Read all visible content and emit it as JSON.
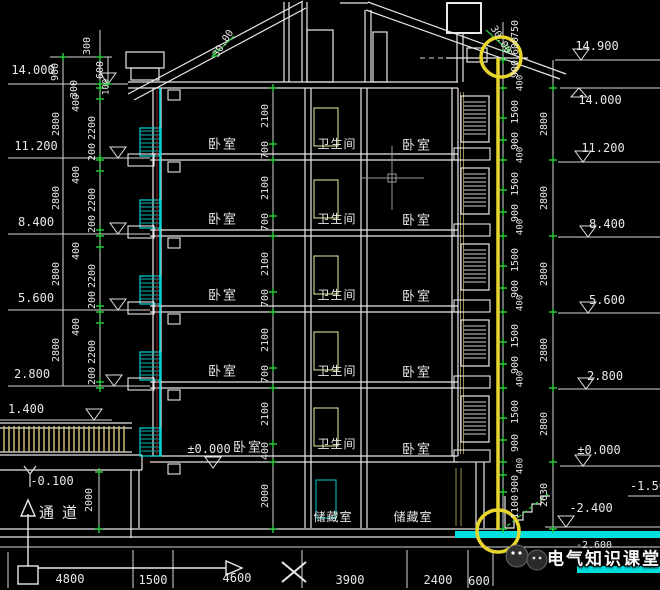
{
  "colors": {
    "background": "#000000",
    "structure_line": "#e8e8e8",
    "cyan": "#00d8d8",
    "green_tick": "#2ecc40",
    "highlight_yellow": "#e8d52c",
    "door_yellow": "#d8d890",
    "wall_core_red": "#8b2020",
    "tan": "#9a8a50"
  },
  "watermark": {
    "text": "电气知识课堂"
  },
  "annotations": [
    {
      "name": "elevation-left-14000",
      "text": "14.000",
      "x": 33,
      "y": 70,
      "size": 12
    },
    {
      "name": "elevation-left-11200",
      "text": "11.200",
      "x": 36,
      "y": 146,
      "size": 12
    },
    {
      "name": "elevation-left-8400",
      "text": "8.400",
      "x": 36,
      "y": 222,
      "size": 12
    },
    {
      "name": "elevation-left-5600",
      "text": "5.600",
      "x": 36,
      "y": 298,
      "size": 12
    },
    {
      "name": "elevation-left-2800",
      "text": "2.800",
      "x": 32,
      "y": 374,
      "size": 12
    },
    {
      "name": "elevation-left-1400",
      "text": "1.400",
      "x": 26,
      "y": 409,
      "size": 12
    },
    {
      "name": "elevation-left-minus-0100",
      "text": "-0.100",
      "x": 52,
      "y": 481,
      "size": 12
    },
    {
      "name": "elevation-left-pm-0000",
      "text": "±0.000",
      "x": 209,
      "y": 449,
      "size": 12
    },
    {
      "name": "elevation-right-14900",
      "text": "14.900",
      "x": 597,
      "y": 46,
      "size": 12
    },
    {
      "name": "elevation-right-14000",
      "text": "14.000",
      "x": 600,
      "y": 100,
      "size": 12
    },
    {
      "name": "elevation-right-11200",
      "text": "11.200",
      "x": 603,
      "y": 148,
      "size": 12
    },
    {
      "name": "elevation-right-8400",
      "text": "8.400",
      "x": 607,
      "y": 224,
      "size": 12
    },
    {
      "name": "elevation-right-5600",
      "text": "5.600",
      "x": 607,
      "y": 300,
      "size": 12
    },
    {
      "name": "elevation-right-2800",
      "text": "2.800",
      "x": 605,
      "y": 376,
      "size": 12
    },
    {
      "name": "elevation-right-pm-0000",
      "text": "±0.000",
      "x": 599,
      "y": 450,
      "size": 12
    },
    {
      "name": "elevation-right-minus-2400",
      "text": "-2.400",
      "x": 591,
      "y": 508,
      "size": 12
    },
    {
      "name": "elevation-right-minus-1500",
      "text": "-1.50",
      "x": 648,
      "y": 486,
      "size": 12
    },
    {
      "name": "elevation-right-minus-2600",
      "text": "-2.600",
      "x": 594,
      "y": 546,
      "size": 10
    },
    {
      "name": "room-bedroom-left-attic",
      "text": "卧室",
      "x": 223,
      "y": 144,
      "size": 13,
      "ls": 2,
      "cjk": 1
    },
    {
      "name": "room-bedroom-left-4f",
      "text": "卧室",
      "x": 223,
      "y": 219,
      "size": 13,
      "ls": 2,
      "cjk": 1
    },
    {
      "name": "room-bedroom-left-3f",
      "text": "卧室",
      "x": 223,
      "y": 295,
      "size": 13,
      "ls": 2,
      "cjk": 1
    },
    {
      "name": "room-bedroom-left-2f",
      "text": "卧室",
      "x": 223,
      "y": 371,
      "size": 13,
      "ls": 2,
      "cjk": 1
    },
    {
      "name": "room-bedroom-left-1f",
      "text": "卧室",
      "x": 248,
      "y": 447,
      "size": 13,
      "ls": 2,
      "cjk": 1
    },
    {
      "name": "room-bathroom-attic",
      "text": "卫生间",
      "x": 337,
      "y": 144,
      "size": 12,
      "ls": 1,
      "cjk": 1
    },
    {
      "name": "room-bathroom-4f",
      "text": "卫生间",
      "x": 337,
      "y": 219,
      "size": 12,
      "ls": 1,
      "cjk": 1
    },
    {
      "name": "room-bathroom-3f",
      "text": "卫生间",
      "x": 337,
      "y": 295,
      "size": 12,
      "ls": 1,
      "cjk": 1
    },
    {
      "name": "room-bathroom-2f",
      "text": "卫生间",
      "x": 337,
      "y": 371,
      "size": 12,
      "ls": 1,
      "cjk": 1
    },
    {
      "name": "room-bathroom-1f",
      "text": "卫生间",
      "x": 337,
      "y": 444,
      "size": 12,
      "ls": 1,
      "cjk": 1
    },
    {
      "name": "room-bedroom-right-attic",
      "text": "卧室",
      "x": 417,
      "y": 145,
      "size": 13,
      "ls": 2,
      "cjk": 1
    },
    {
      "name": "room-bedroom-right-4f",
      "text": "卧室",
      "x": 417,
      "y": 220,
      "size": 13,
      "ls": 2,
      "cjk": 1
    },
    {
      "name": "room-bedroom-right-3f",
      "text": "卧室",
      "x": 417,
      "y": 296,
      "size": 13,
      "ls": 2,
      "cjk": 1
    },
    {
      "name": "room-bedroom-right-2f",
      "text": "卧室",
      "x": 417,
      "y": 372,
      "size": 13,
      "ls": 2,
      "cjk": 1
    },
    {
      "name": "room-bedroom-right-1f",
      "text": "卧室",
      "x": 417,
      "y": 449,
      "size": 13,
      "ls": 2,
      "cjk": 1
    },
    {
      "name": "room-storage-1",
      "text": "储藏室",
      "x": 333,
      "y": 517,
      "size": 12,
      "ls": 1,
      "cjk": 1
    },
    {
      "name": "room-storage-2",
      "text": "储藏室",
      "x": 413,
      "y": 517,
      "size": 12,
      "ls": 1,
      "cjk": 1
    },
    {
      "name": "room-passage",
      "text": "通道",
      "x": 62,
      "y": 513,
      "size": 15,
      "ls": 8,
      "cjk": 1
    },
    {
      "name": "dim-topleft-900",
      "text": "900",
      "x": 56,
      "y": 72,
      "size": 10,
      "rot": -90
    },
    {
      "name": "dim-topleft-300a",
      "text": "300",
      "x": 88,
      "y": 46,
      "size": 10,
      "rot": -90
    },
    {
      "name": "dim-topleft-600",
      "text": "600",
      "x": 101,
      "y": 70,
      "size": 10,
      "rot": -90
    },
    {
      "name": "dim-topleft-100",
      "text": "100",
      "x": 107,
      "y": 87,
      "size": 9,
      "rot": -90
    },
    {
      "name": "dim-topleft-300b",
      "text": "300",
      "x": 75,
      "y": 89,
      "size": 10,
      "rot": -90
    },
    {
      "name": "dim-left-2800-1",
      "text": "2800",
      "x": 57,
      "y": 124,
      "size": 10,
      "rot": -90
    },
    {
      "name": "dim-left-2800-2",
      "text": "2800",
      "x": 57,
      "y": 198,
      "size": 10,
      "rot": -90
    },
    {
      "name": "dim-left-2800-3",
      "text": "2800",
      "x": 57,
      "y": 274,
      "size": 10,
      "rot": -90
    },
    {
      "name": "dim-left-2800-4",
      "text": "2800",
      "x": 57,
      "y": 350,
      "size": 10,
      "rot": -90
    },
    {
      "name": "dim-left-400-1",
      "text": "400",
      "x": 77,
      "y": 103,
      "size": 10,
      "rot": -90
    },
    {
      "name": "dim-left-400-2",
      "text": "400",
      "x": 77,
      "y": 175,
      "size": 10,
      "rot": -90
    },
    {
      "name": "dim-left-400-3",
      "text": "400",
      "x": 77,
      "y": 251,
      "size": 10,
      "rot": -90
    },
    {
      "name": "dim-left-400-4",
      "text": "400",
      "x": 77,
      "y": 327,
      "size": 10,
      "rot": -90
    },
    {
      "name": "dim-left-2200-1",
      "text": "2200",
      "x": 93,
      "y": 128,
      "size": 10,
      "rot": -90
    },
    {
      "name": "dim-left-2200-2",
      "text": "2200",
      "x": 93,
      "y": 200,
      "size": 10,
      "rot": -90
    },
    {
      "name": "dim-left-2200-3",
      "text": "2200",
      "x": 93,
      "y": 276,
      "size": 10,
      "rot": -90
    },
    {
      "name": "dim-left-2200-4",
      "text": "2200",
      "x": 93,
      "y": 352,
      "size": 10,
      "rot": -90
    },
    {
      "name": "dim-left-200-1",
      "text": "200",
      "x": 93,
      "y": 152,
      "size": 10,
      "rot": -90
    },
    {
      "name": "dim-left-200-2",
      "text": "200",
      "x": 93,
      "y": 224,
      "size": 10,
      "rot": -90
    },
    {
      "name": "dim-left-200-3",
      "text": "200",
      "x": 93,
      "y": 300,
      "size": 10,
      "rot": -90
    },
    {
      "name": "dim-left-200-4",
      "text": "200",
      "x": 93,
      "y": 376,
      "size": 10,
      "rot": -90
    },
    {
      "name": "dim-passage-2000",
      "text": "2000",
      "x": 90,
      "y": 500,
      "size": 10,
      "rot": -90
    },
    {
      "name": "dim-center-2100-1",
      "text": "2100",
      "x": 266,
      "y": 116,
      "size": 10,
      "rot": -90
    },
    {
      "name": "dim-center-2100-2",
      "text": "2100",
      "x": 266,
      "y": 188,
      "size": 10,
      "rot": -90
    },
    {
      "name": "dim-center-2100-3",
      "text": "2100",
      "x": 266,
      "y": 264,
      "size": 10,
      "rot": -90
    },
    {
      "name": "dim-center-2100-4",
      "text": "2100",
      "x": 266,
      "y": 340,
      "size": 10,
      "rot": -90
    },
    {
      "name": "dim-center-2100-5",
      "text": "2100",
      "x": 266,
      "y": 414,
      "size": 10,
      "rot": -90
    },
    {
      "name": "dim-center-700-1",
      "text": "700",
      "x": 266,
      "y": 150,
      "size": 10,
      "rot": -90
    },
    {
      "name": "dim-center-700-2",
      "text": "700",
      "x": 266,
      "y": 222,
      "size": 10,
      "rot": -90
    },
    {
      "name": "dim-center-700-3",
      "text": "700",
      "x": 266,
      "y": 298,
      "size": 10,
      "rot": -90
    },
    {
      "name": "dim-center-700-4",
      "text": "700",
      "x": 266,
      "y": 374,
      "size": 10,
      "rot": -90
    },
    {
      "name": "dim-center-400",
      "text": "400",
      "x": 266,
      "y": 451,
      "size": 10,
      "rot": -90
    },
    {
      "name": "dim-center-2000",
      "text": "2000",
      "x": 266,
      "y": 496,
      "size": 10,
      "rot": -90
    },
    {
      "name": "dim-righttop-750",
      "text": "750",
      "x": 516,
      "y": 29,
      "size": 10,
      "rot": -90
    },
    {
      "name": "dim-righttop-600",
      "text": "600",
      "x": 516,
      "y": 46,
      "size": 10,
      "rot": -90
    },
    {
      "name": "dim-righttop-900",
      "text": "900",
      "x": 516,
      "y": 69,
      "size": 10,
      "rot": -90
    },
    {
      "name": "dim-righttop-400",
      "text": "400",
      "x": 521,
      "y": 83,
      "size": 9,
      "rot": -90
    },
    {
      "name": "dim-right-1500-1",
      "text": "1500",
      "x": 516,
      "y": 112,
      "size": 10,
      "rot": -90
    },
    {
      "name": "dim-right-1500-2",
      "text": "1500",
      "x": 516,
      "y": 184,
      "size": 10,
      "rot": -90
    },
    {
      "name": "dim-right-1500-3",
      "text": "1500",
      "x": 516,
      "y": 260,
      "size": 10,
      "rot": -90
    },
    {
      "name": "dim-right-1500-4",
      "text": "1500",
      "x": 516,
      "y": 336,
      "size": 10,
      "rot": -90
    },
    {
      "name": "dim-right-1500-5",
      "text": "1500",
      "x": 516,
      "y": 412,
      "size": 10,
      "rot": -90
    },
    {
      "name": "dim-right-900-1",
      "text": "900",
      "x": 516,
      "y": 141,
      "size": 10,
      "rot": -90
    },
    {
      "name": "dim-right-900-2",
      "text": "900",
      "x": 516,
      "y": 213,
      "size": 10,
      "rot": -90
    },
    {
      "name": "dim-right-900-3",
      "text": "900",
      "x": 516,
      "y": 289,
      "size": 10,
      "rot": -90
    },
    {
      "name": "dim-right-900-4",
      "text": "900",
      "x": 516,
      "y": 365,
      "size": 10,
      "rot": -90
    },
    {
      "name": "dim-right-900-5",
      "text": "900",
      "x": 516,
      "y": 443,
      "size": 10,
      "rot": -90
    },
    {
      "name": "dim-right-400-1",
      "text": "400",
      "x": 521,
      "y": 155,
      "size": 9,
      "rot": -90
    },
    {
      "name": "dim-right-400-2",
      "text": "400",
      "x": 521,
      "y": 227,
      "size": 9,
      "rot": -90
    },
    {
      "name": "dim-right-400-3",
      "text": "400",
      "x": 521,
      "y": 303,
      "size": 9,
      "rot": -90
    },
    {
      "name": "dim-right-400-4",
      "text": "400",
      "x": 521,
      "y": 379,
      "size": 9,
      "rot": -90
    },
    {
      "name": "dim-right-400-5",
      "text": "400",
      "x": 521,
      "y": 466,
      "size": 9,
      "rot": -90
    },
    {
      "name": "dim-right-900-base",
      "text": "900",
      "x": 516,
      "y": 484,
      "size": 10,
      "rot": -90
    },
    {
      "name": "dim-right-1100",
      "text": "1100",
      "x": 516,
      "y": 507,
      "size": 10,
      "rot": -90
    },
    {
      "name": "dim-right-2800-1",
      "text": "2800",
      "x": 545,
      "y": 124,
      "size": 10,
      "rot": -90
    },
    {
      "name": "dim-right-2800-2",
      "text": "2800",
      "x": 545,
      "y": 198,
      "size": 10,
      "rot": -90
    },
    {
      "name": "dim-right-2800-3",
      "text": "2800",
      "x": 545,
      "y": 274,
      "size": 10,
      "rot": -90
    },
    {
      "name": "dim-right-2800-4",
      "text": "2800",
      "x": 545,
      "y": 350,
      "size": 10,
      "rot": -90
    },
    {
      "name": "dim-right-2800-5",
      "text": "2800",
      "x": 545,
      "y": 424,
      "size": 10,
      "rot": -90
    },
    {
      "name": "dim-right-2630",
      "text": "2630",
      "x": 545,
      "y": 495,
      "size": 10,
      "rot": -90
    },
    {
      "name": "slope-left-3000",
      "text": "30.00",
      "x": 224,
      "y": 44,
      "size": 10,
      "rot": -58
    },
    {
      "name": "slope-right-3000",
      "text": "30.00",
      "x": 500,
      "y": 40,
      "size": 10,
      "rot": 58
    },
    {
      "name": "dim-bottom-4800",
      "text": "4800",
      "x": 70,
      "y": 579,
      "size": 12
    },
    {
      "name": "dim-bottom-1500",
      "text": "1500",
      "x": 153,
      "y": 580,
      "size": 12
    },
    {
      "name": "dim-bottom-4600",
      "text": "4600",
      "x": 237,
      "y": 578,
      "size": 12
    },
    {
      "name": "dim-bottom-3900",
      "text": "3900",
      "x": 350,
      "y": 580,
      "size": 12
    },
    {
      "name": "dim-bottom-2400",
      "text": "2400",
      "x": 438,
      "y": 580,
      "size": 12
    },
    {
      "name": "dim-bottom-600",
      "text": "600",
      "x": 479,
      "y": 581,
      "size": 12
    }
  ]
}
